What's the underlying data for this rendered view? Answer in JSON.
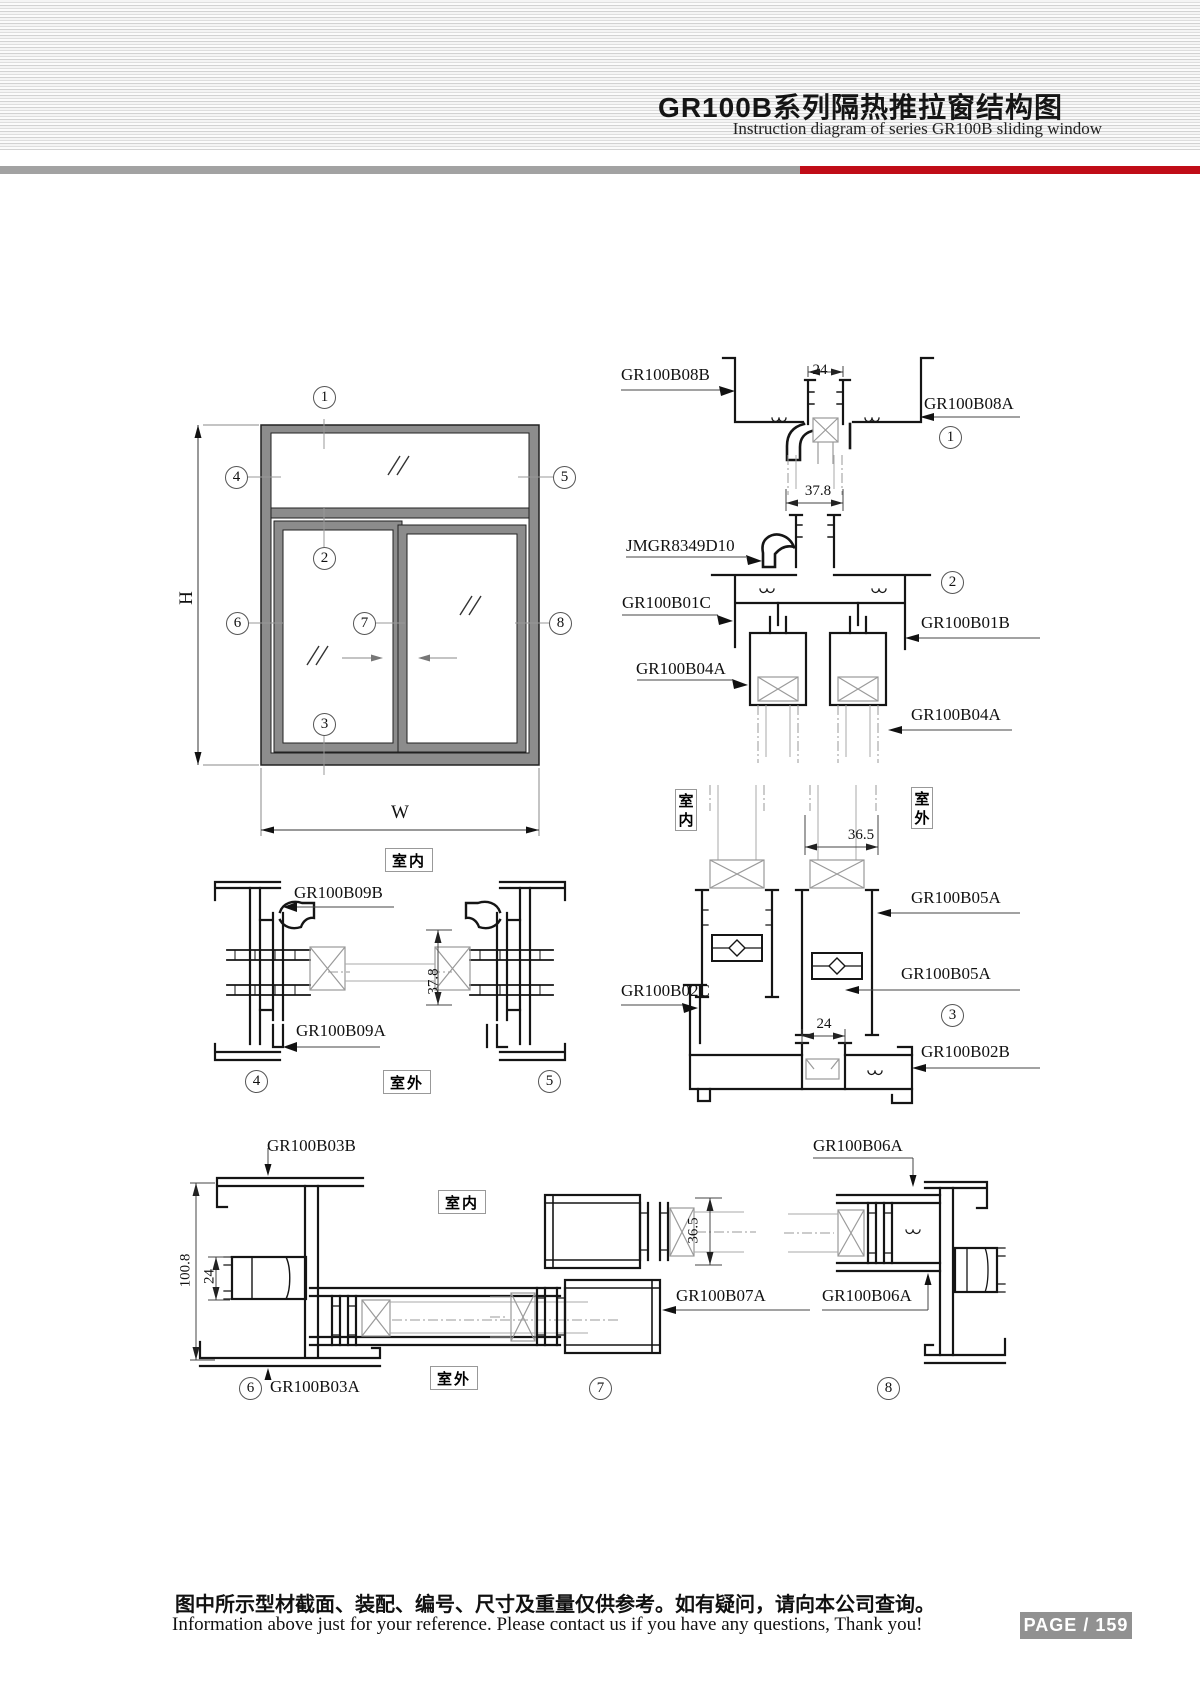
{
  "header": {
    "title_cn": "GR100B系列隔热推拉窗结构图",
    "title_en": "Instruction diagram of series GR100B sliding window"
  },
  "room": {
    "indoor": "室内",
    "outdoor": "室外"
  },
  "elevation": {
    "h": "H",
    "w": "W"
  },
  "callouts": {
    "c1": "1",
    "c2": "2",
    "c3": "3",
    "c4": "4",
    "c5": "5",
    "c6": "6",
    "c7": "7",
    "c8": "8"
  },
  "s1": {
    "left": "GR100B08B",
    "right": "GR100B08A",
    "dim": "24"
  },
  "s2": {
    "insert": "JMGR8349D10",
    "left_top": "GR100B01C",
    "right_top": "GR100B01B",
    "left_bottom": "GR100B04A",
    "right_bottom": "GR100B04A",
    "dim": "37.8"
  },
  "s3": {
    "dim_top": "36.5",
    "right1": "GR100B05A",
    "right2": "GR100B05A",
    "left": "GR100B02C",
    "dim_bottom": "24",
    "right3": "GR100B02B"
  },
  "s4": {
    "top": "GR100B09B",
    "bottom": "GR100B09A"
  },
  "s5": {
    "dim": "37.8"
  },
  "s6": {
    "top": "GR100B03B",
    "bottom": "GR100B03A",
    "dim_outer": "100.8",
    "dim_inner": "24"
  },
  "s7": {
    "dim": "36.5",
    "label": "GR100B07A"
  },
  "s8": {
    "top": "GR100B06A",
    "bottom": "GR100B06A"
  },
  "footer": {
    "note_cn": "图中所示型材截面、装配、编号、尺寸及重量仅供参考。如有疑问，请向本公司查询。",
    "note_en": "Information above just for your reference. Please contact us if you have any questions, Thank you!",
    "page": "PAGE / 159"
  }
}
